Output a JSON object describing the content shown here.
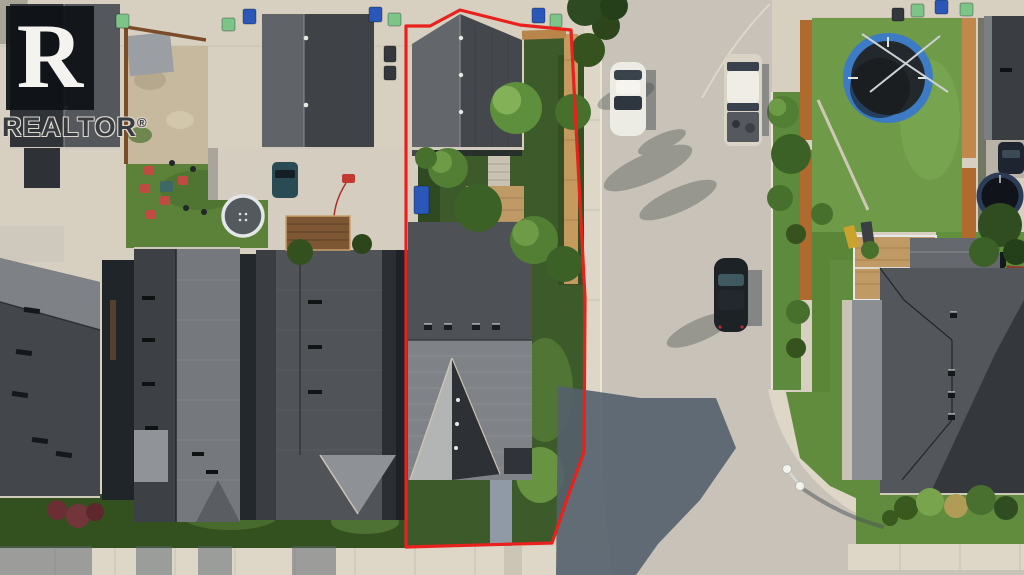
{
  "watermark": {
    "logo_letter": "R",
    "brand_name": "REALTOR",
    "registered_mark": "®"
  },
  "scene_description": "Aerial drone photo of a suburban street; subject lot outlined in red with detached rear garage, treed backyard and front-gabled house facing a curving street",
  "palette": {
    "base": "#d7d0c1",
    "street": "#c8c2b8",
    "sidewalk": "#ded7c8",
    "curb": "#ebe5d6",
    "roof_dark": "#3d4145",
    "roof_mid": "#54585c",
    "roof_light": "#7e8186",
    "roof_pale": "#9b9ea2",
    "grass": "#5d8a3c",
    "grass_dark": "#2e4a21",
    "grass_bright": "#74a24a",
    "dirt": "#c6b99e",
    "shadow": "#55616d",
    "fence_tan": "#c59a5e",
    "fence_orange": "#b06a2e",
    "fence_brown": "#7a4c2a",
    "red_accent": "#e8211d",
    "bin_blue": "#2b57b8",
    "bin_green": "#7cc487",
    "bin_dark": "#34383c",
    "trampoline_blue": "#3d7bc4",
    "deck_wood": "#c09a64",
    "vehicle_white": "#ecebe4",
    "vehicle_black": "#1d2227",
    "vehicle_teal": "#2a4a54",
    "toy_red": "#c23a30"
  },
  "scene": {
    "vehicles": [
      {
        "name": "white-sedan",
        "color": "white",
        "location": "parked west side of street"
      },
      {
        "name": "white-pickup-truck",
        "color": "white",
        "location": "parked east side of street"
      },
      {
        "name": "black-car",
        "color": "black",
        "location": "parked east side of street, mid-block"
      }
    ],
    "trampolines": [
      {
        "name": "blue-trampoline",
        "location": "right backyard"
      },
      {
        "name": "gray-trampoline",
        "location": "left backyard"
      },
      {
        "name": "dark-trampoline",
        "location": "far-right backyard"
      }
    ],
    "bins": [
      {
        "x": 116,
        "y": 14,
        "w": 13,
        "h": 14,
        "c": "green"
      },
      {
        "x": 222,
        "y": 18,
        "w": 13,
        "h": 13,
        "c": "green"
      },
      {
        "x": 243,
        "y": 9,
        "w": 13,
        "h": 15,
        "c": "blue"
      },
      {
        "x": 369,
        "y": 7,
        "w": 13,
        "h": 15,
        "c": "blue"
      },
      {
        "x": 388,
        "y": 13,
        "w": 13,
        "h": 13,
        "c": "green"
      },
      {
        "x": 532,
        "y": 8,
        "w": 13,
        "h": 15,
        "c": "blue"
      },
      {
        "x": 550,
        "y": 14,
        "w": 12,
        "h": 13,
        "c": "green"
      },
      {
        "x": 384,
        "y": 46,
        "w": 12,
        "h": 16,
        "c": "dark"
      },
      {
        "x": 384,
        "y": 66,
        "w": 12,
        "h": 14,
        "c": "dark"
      },
      {
        "x": 892,
        "y": 8,
        "w": 12,
        "h": 13,
        "c": "dark"
      },
      {
        "x": 911,
        "y": 4,
        "w": 13,
        "h": 13,
        "c": "green"
      },
      {
        "x": 935,
        "y": 0,
        "w": 13,
        "h": 14,
        "c": "blue"
      },
      {
        "x": 960,
        "y": 3,
        "w": 13,
        "h": 13,
        "c": "green"
      },
      {
        "x": 414,
        "y": 186,
        "w": 15,
        "h": 28,
        "c": "blue"
      }
    ],
    "trees": [
      {
        "x": 516,
        "y": 108,
        "r": 26,
        "f": "#5e8f3c",
        "hi": "#82b158"
      },
      {
        "x": 573,
        "y": 112,
        "r": 18,
        "f": "#46702c"
      },
      {
        "x": 448,
        "y": 168,
        "r": 20,
        "f": "#527f34",
        "hi": "#6e9c46"
      },
      {
        "x": 478,
        "y": 208,
        "r": 24,
        "f": "#3c6126"
      },
      {
        "x": 534,
        "y": 240,
        "r": 24,
        "f": "#527f34",
        "hi": "#6e9c46"
      },
      {
        "x": 564,
        "y": 264,
        "r": 18,
        "f": "#3c6126"
      },
      {
        "x": 426,
        "y": 158,
        "r": 11,
        "f": "#46702c"
      },
      {
        "x": 588,
        "y": 50,
        "r": 17,
        "f": "#35521f"
      },
      {
        "x": 606,
        "y": 26,
        "r": 14,
        "f": "#2c451b"
      },
      {
        "x": 585,
        "y": 8,
        "r": 18,
        "f": "#2e4a22"
      },
      {
        "x": 614,
        "y": 6,
        "r": 14,
        "f": "#253f1a"
      },
      {
        "x": 783,
        "y": 112,
        "r": 16,
        "f": "#527f34",
        "hi": "#6e9c46"
      },
      {
        "x": 791,
        "y": 154,
        "r": 20,
        "f": "#3c6126"
      },
      {
        "x": 780,
        "y": 198,
        "r": 13,
        "f": "#46702c"
      },
      {
        "x": 796,
        "y": 234,
        "r": 10,
        "f": "#35521f"
      },
      {
        "x": 798,
        "y": 312,
        "r": 12,
        "f": "#46702c"
      },
      {
        "x": 796,
        "y": 348,
        "r": 10,
        "f": "#35521f"
      },
      {
        "x": 822,
        "y": 214,
        "r": 11,
        "f": "#46702c"
      },
      {
        "x": 300,
        "y": 252,
        "r": 13,
        "f": "#33511f"
      },
      {
        "x": 362,
        "y": 244,
        "r": 10,
        "f": "#2c451b"
      },
      {
        "x": 1000,
        "y": 225,
        "r": 22,
        "f": "#2f4d20"
      },
      {
        "x": 984,
        "y": 252,
        "r": 15,
        "f": "#3c6128"
      },
      {
        "x": 1016,
        "y": 252,
        "r": 13,
        "f": "#24401a"
      },
      {
        "x": 906,
        "y": 508,
        "r": 12,
        "f": "#39591f"
      },
      {
        "x": 930,
        "y": 502,
        "r": 14,
        "f": "#77a44c"
      },
      {
        "x": 956,
        "y": 506,
        "r": 12,
        "f": "#b09c56"
      },
      {
        "x": 981,
        "y": 500,
        "r": 15,
        "f": "#4a7030"
      },
      {
        "x": 1006,
        "y": 508,
        "r": 12,
        "f": "#2f4d20"
      },
      {
        "x": 890,
        "y": 518,
        "r": 8,
        "f": "#39591f"
      },
      {
        "x": 870,
        "y": 250,
        "r": 9,
        "f": "#46702c"
      },
      {
        "x": 57,
        "y": 510,
        "r": 10,
        "f": "#6a2e33"
      },
      {
        "x": 78,
        "y": 516,
        "r": 12,
        "f": "#73353a"
      },
      {
        "x": 95,
        "y": 512,
        "r": 9,
        "f": "#5d272c"
      }
    ]
  }
}
